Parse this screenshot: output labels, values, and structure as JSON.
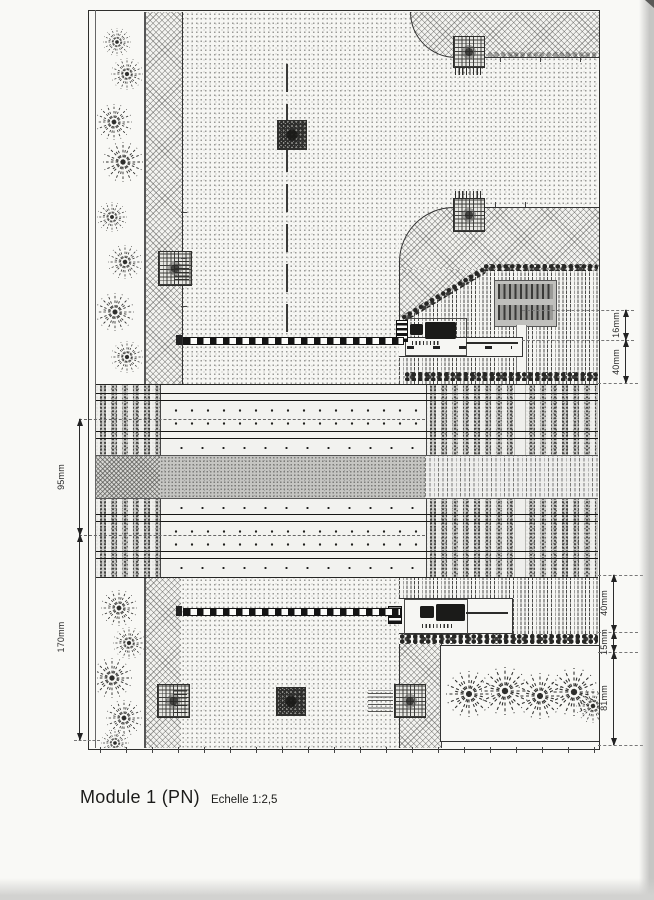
{
  "title": {
    "module": "Module 1 (PN)",
    "scale": "Echelle 1:2,5"
  },
  "dimensions": {
    "left": [
      {
        "id": "track-spacing",
        "label": "95mm"
      },
      {
        "id": "lower-module-depth",
        "label": "170mm"
      }
    ],
    "right_upper": [
      {
        "id": "farm-road-width-upper",
        "label": "16mm"
      },
      {
        "id": "field-depth-upper",
        "label": "40mm"
      }
    ],
    "right_lower": [
      {
        "id": "field-depth-lower",
        "label": "40mm"
      },
      {
        "id": "hedge-strip",
        "label": "15mm"
      },
      {
        "id": "bush-area-depth",
        "label": "81mm"
      }
    ]
  },
  "colors": {
    "paper": "#f9f9f6",
    "ink": "#2b2b2b",
    "ballast_gray": "#c9c9c6",
    "paved_median_gray": "#c5c5c2",
    "barrier_black": "#141414"
  }
}
